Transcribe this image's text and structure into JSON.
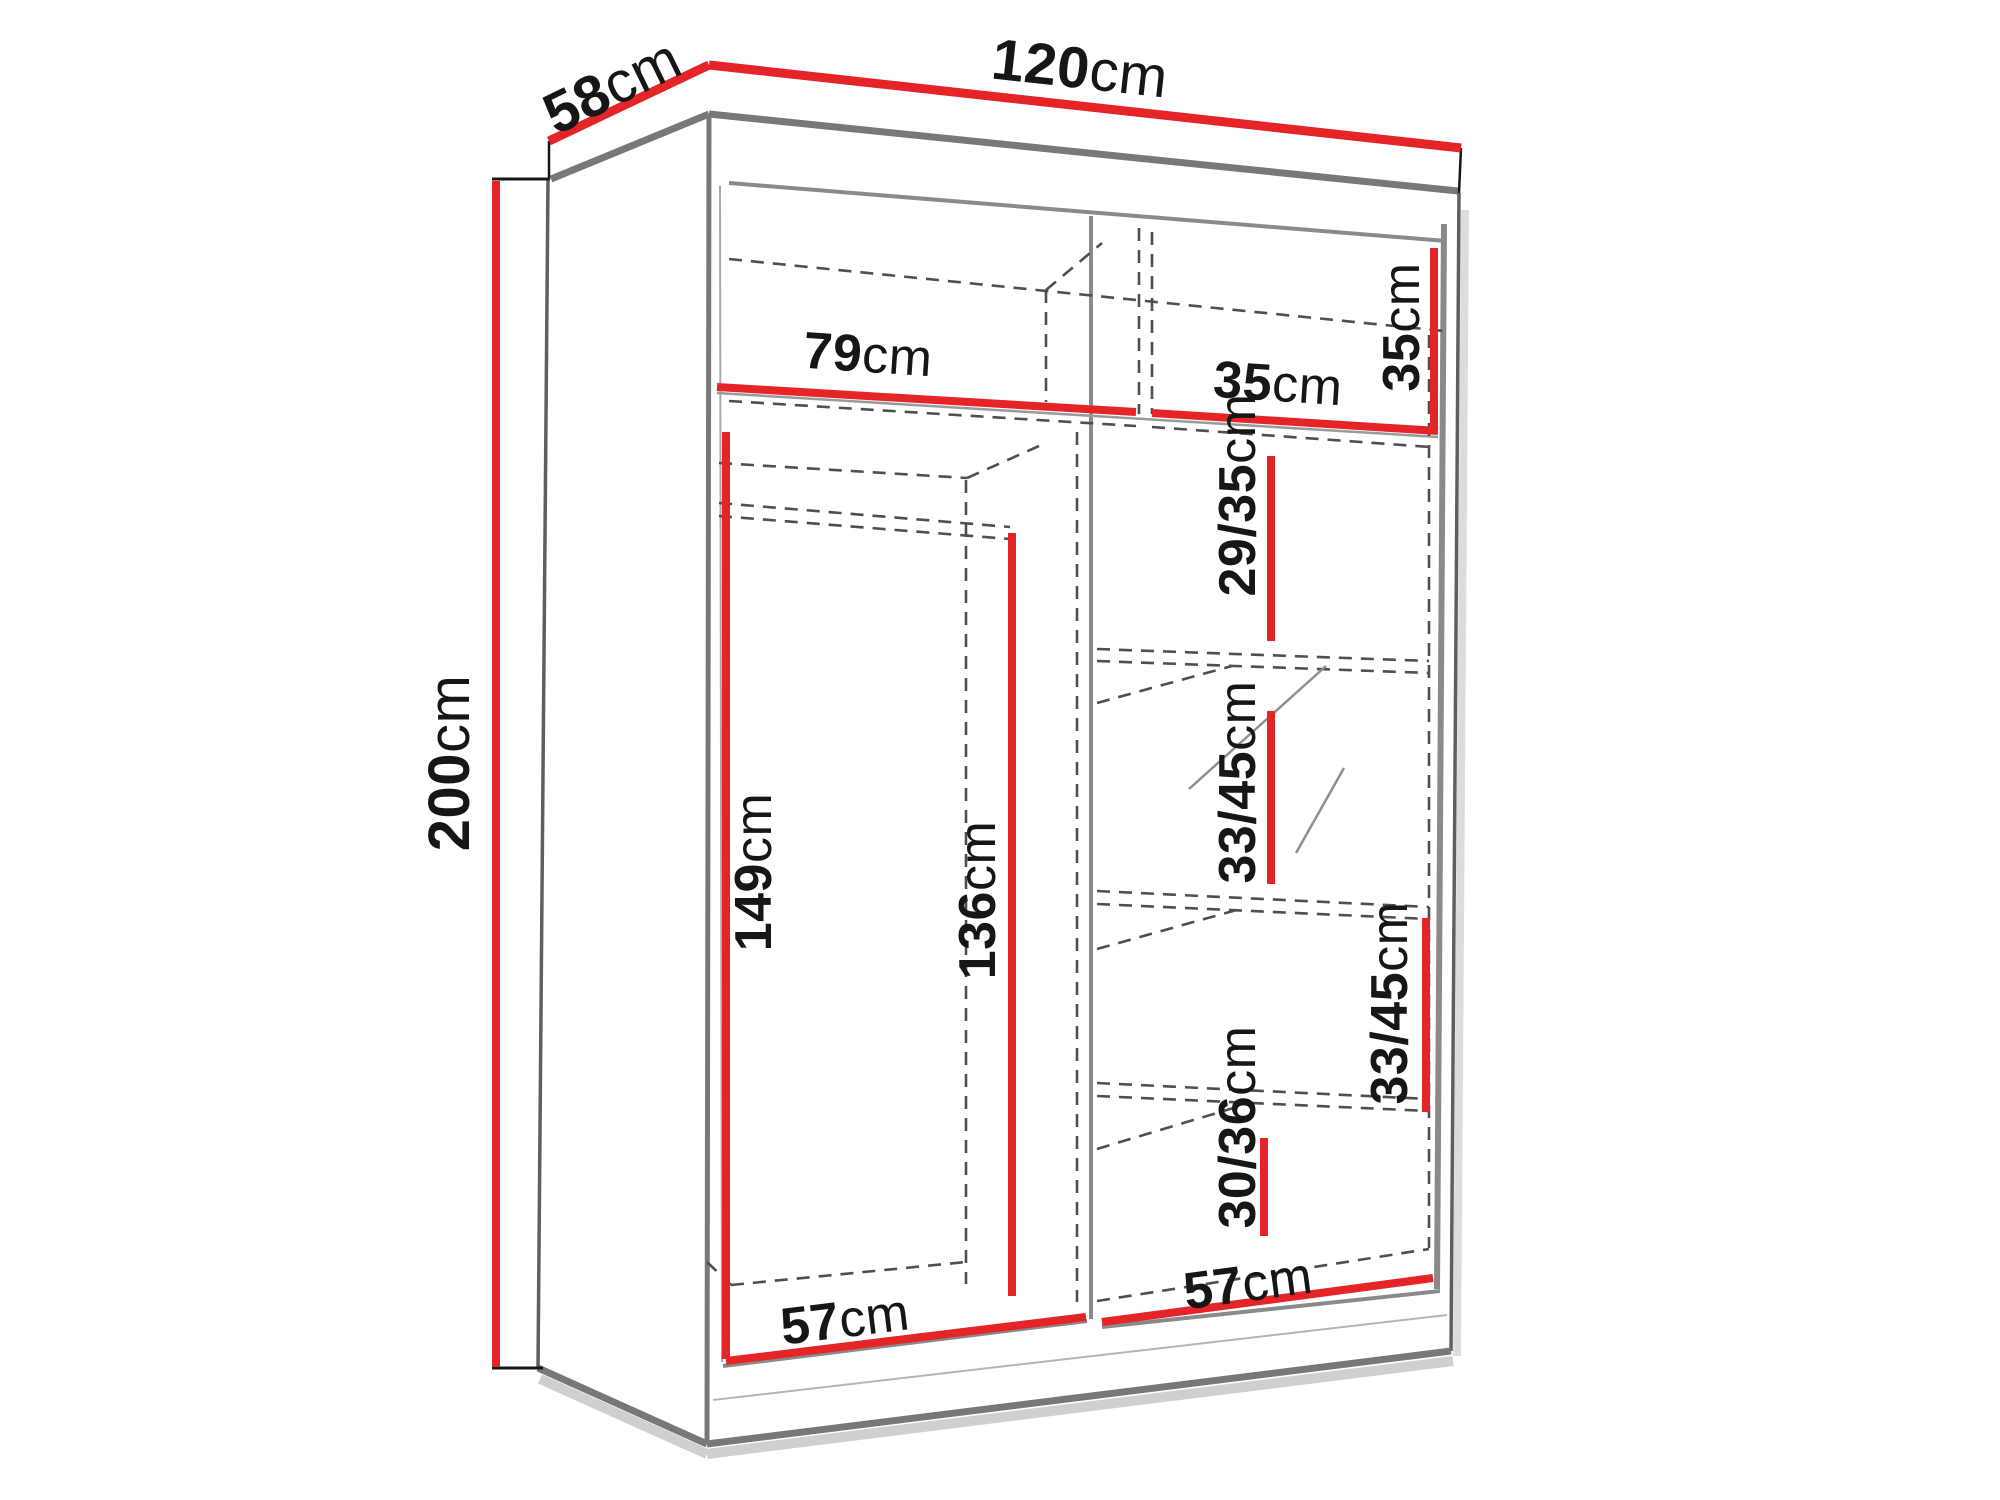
{
  "colors": {
    "dimension": "#e42427",
    "text": "#161616"
  },
  "diagram": {
    "type": "wardrobe-dimension-drawing",
    "labels": {
      "width": {
        "value": "120",
        "unit": "cm"
      },
      "depth": {
        "value": "58",
        "unit": "cm"
      },
      "height": {
        "value": "200",
        "unit": "cm"
      },
      "top_left_width": {
        "value": "79",
        "unit": "cm"
      },
      "top_right_width": {
        "value": "35",
        "unit": "cm"
      },
      "top_section_height": {
        "value": "35",
        "unit": "cm"
      },
      "shelf_section_1_height": {
        "value": "29/35",
        "unit": "cm"
      },
      "shelf_section_2_height": {
        "value": "33/45",
        "unit": "cm"
      },
      "shelf_section_3_height": {
        "value": "33/45",
        "unit": "cm"
      },
      "shelf_section_4_height": {
        "value": "30/36",
        "unit": "cm"
      },
      "left_opening_height": {
        "value": "149",
        "unit": "cm"
      },
      "hanging_space_height": {
        "value": "136",
        "unit": "cm"
      },
      "left_floor_width": {
        "value": "57",
        "unit": "cm"
      },
      "right_floor_width": {
        "value": "57",
        "unit": "cm"
      }
    }
  }
}
